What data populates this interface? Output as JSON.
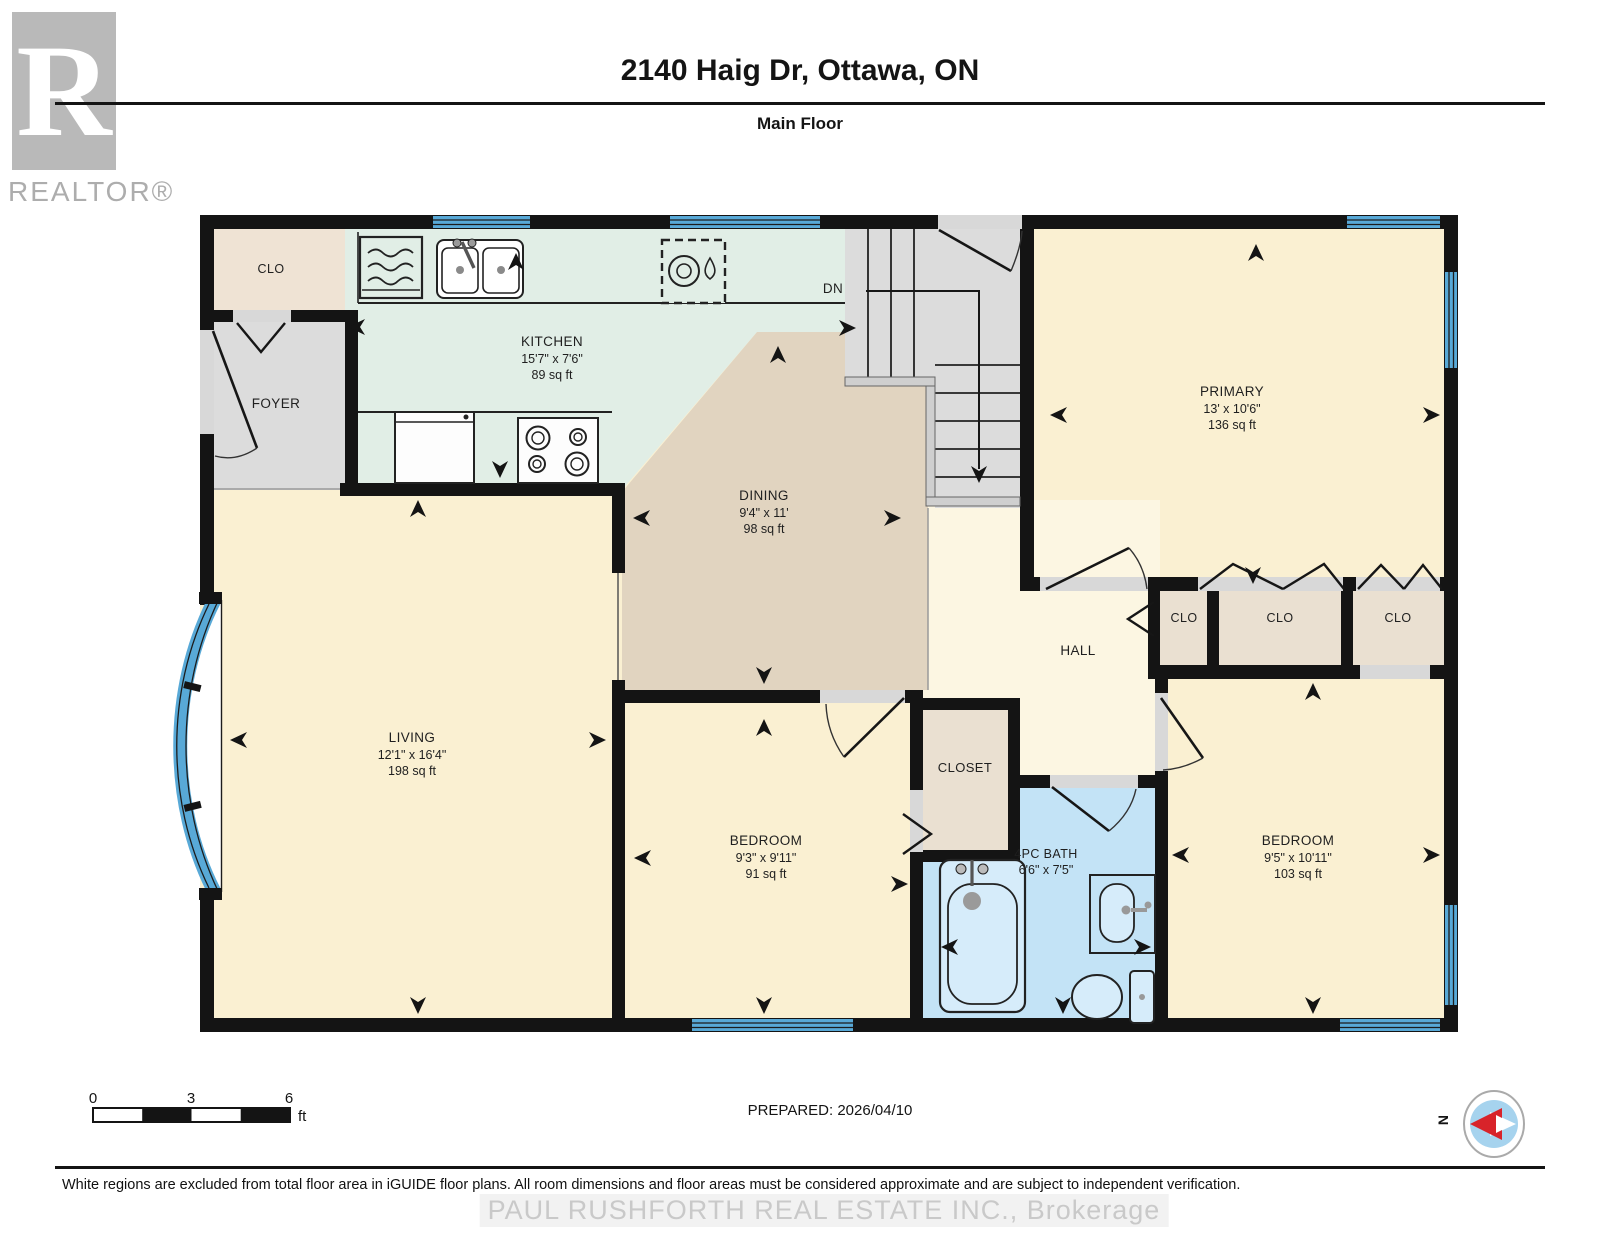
{
  "header": {
    "logo_r": "R",
    "logo_text": "REALTOR®",
    "title": "2140 Haig Dr, Ottawa, ON",
    "subtitle": "Main Floor"
  },
  "rooms": {
    "kitchen": {
      "name": "KITCHEN",
      "dims": "15'7\" x 7'6\"",
      "area": "89 sq ft"
    },
    "dining": {
      "name": "DINING",
      "dims": "9'4\" x 11'",
      "area": "98 sq ft"
    },
    "living": {
      "name": "LIVING",
      "dims": "12'1\" x 16'4\"",
      "area": "198 sq ft"
    },
    "primary": {
      "name": "PRIMARY",
      "dims": "13' x 10'6\"",
      "area": "136 sq ft"
    },
    "bedroom_mid": {
      "name": "BEDROOM",
      "dims": "9'3\" x 9'11\"",
      "area": "91 sq ft"
    },
    "bedroom_right": {
      "name": "BEDROOM",
      "dims": "9'5\" x 10'11\"",
      "area": "103 sq ft"
    },
    "bath": {
      "name": "4PC BATH",
      "dims": "6'6\" x 7'5\""
    },
    "foyer": {
      "name": "FOYER"
    },
    "hall": {
      "name": "HALL"
    },
    "closet": {
      "name": "CLOSET"
    },
    "clo_entry": {
      "name": "CLO"
    },
    "clo_1": {
      "name": "CLO"
    },
    "clo_2": {
      "name": "CLO"
    },
    "clo_3": {
      "name": "CLO"
    },
    "stairs_down": {
      "name": "DN"
    }
  },
  "footer": {
    "scale": {
      "t0": "0",
      "t1": "3",
      "t2": "6",
      "unit": "ft"
    },
    "prepared": "PREPARED: 2026/04/10",
    "compass": "N",
    "disclaimer": "White regions are excluded from total floor area in iGUIDE floor plans. All room dimensions and floor areas must be considered approximate and are subject to independent verification.",
    "watermark": "PAUL RUSHFORTH REAL ESTATE INC., Brokerage"
  },
  "colors": {
    "room_yellow": "#FAF0D2",
    "hall_yellow": "#FCF6E2",
    "dining_tan": "#E1D4C0",
    "kitchen_mint": "#E1EEE6",
    "gray_floor": "#DCDCDC",
    "closet_beige": "#EAE0D1",
    "entry_closet_beige": "#EFE3D4",
    "bath_blue": "#C3E3F6",
    "fixture_blue": "#D6ECFA",
    "window_blue": "#58A9D7",
    "wall_black": "#141414"
  }
}
